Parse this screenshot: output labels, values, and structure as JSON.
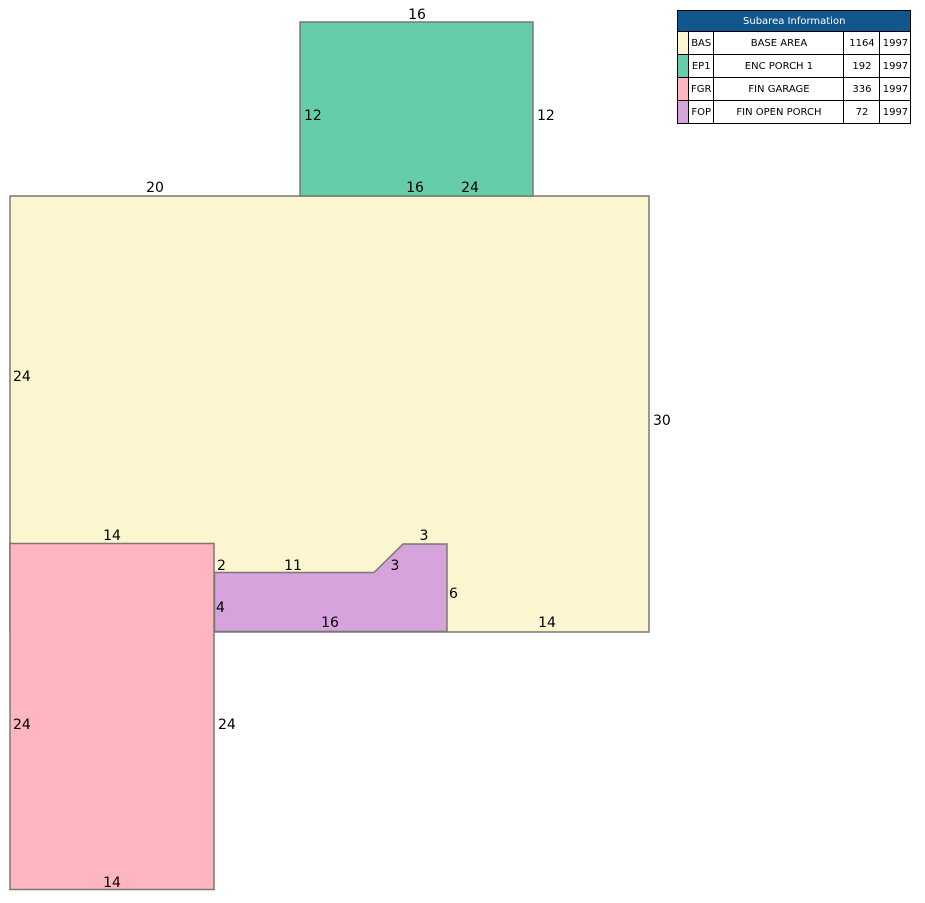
{
  "colors": {
    "base_area_fill": "#FCF6D0",
    "enc_porch_fill": "#66CDAA",
    "fin_garage_fill": "#FFB6C1",
    "fin_open_porch_fill": "#D7A3DC",
    "table_header_bg": "#11568D",
    "table_header_text": "#FFFFFF"
  },
  "sketch": {
    "labels": {
      "ep1_top": "16",
      "ep1_left": "12",
      "ep1_right": "12",
      "bas_top_left": "20",
      "ep1_bottom": "16",
      "bas_top_right": "24",
      "bas_left": "24",
      "bas_right": "30",
      "fgr_top": "14",
      "fop_left_offset": "2",
      "fop_top": "11",
      "fop_diagonal": "3",
      "fop_upper_top": "3",
      "fop_left": "4",
      "fop_right": "6",
      "fop_bottom": "16",
      "bas_bottom": "14",
      "fgr_left": "24",
      "fgr_right": "24",
      "fgr_bottom": "14"
    }
  },
  "subarea_table": {
    "title": "Subarea Information",
    "rows": [
      {
        "code": "BAS",
        "name": "BASE AREA",
        "area": "1164",
        "year": "1997"
      },
      {
        "code": "EP1",
        "name": "ENC PORCH 1",
        "area": "192",
        "year": "1997"
      },
      {
        "code": "FGR",
        "name": "FIN GARAGE",
        "area": "336",
        "year": "1997"
      },
      {
        "code": "FOP",
        "name": "FIN OPEN PORCH",
        "area": "72",
        "year": "1997"
      }
    ]
  }
}
